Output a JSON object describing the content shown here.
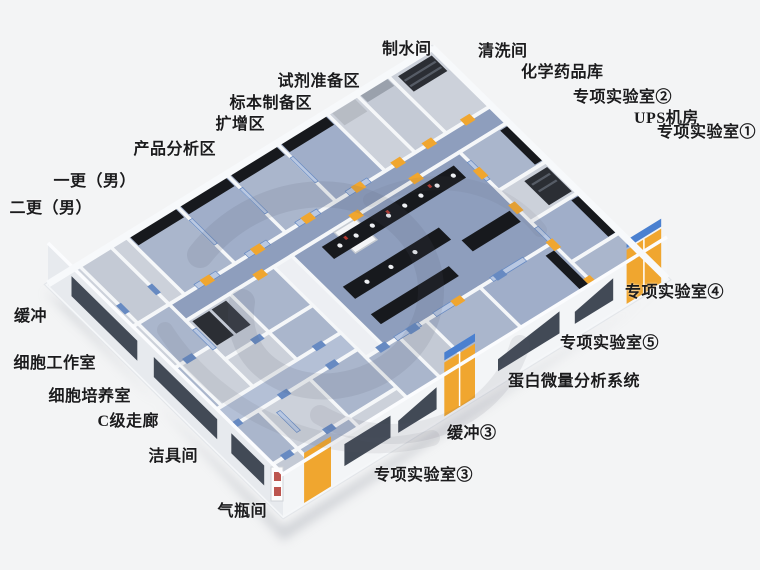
{
  "colors": {
    "background": "#f3f4f5",
    "wall": "#f5f7f9",
    "floor_blue": "#8e9ebd",
    "floor_blue_light": "#aab6cc",
    "floor_gray": "#ccd1da",
    "bench": "#17191d",
    "door_yellow": "#f0a62f",
    "door_blue": "#678ac2",
    "window_dark": "#424a56",
    "sign_blue": "#4a80d0",
    "label_text": "#1b1b1d"
  },
  "labels": [
    {
      "text": "制水间"
    },
    {
      "text": "清洗间"
    },
    {
      "text": "化学药品库"
    },
    {
      "text": "专项实验室②"
    },
    {
      "text": "UPS机房"
    },
    {
      "text": "专项实验室①"
    },
    {
      "text": "试剂准备区"
    },
    {
      "text": "标本制备区"
    },
    {
      "text": "扩增区"
    },
    {
      "text": "产品分析区"
    },
    {
      "text": "一更（男）"
    },
    {
      "text": "二更（男）"
    },
    {
      "text": "缓冲"
    },
    {
      "text": "细胞工作室"
    },
    {
      "text": "细胞培养室"
    },
    {
      "text": "C级走廊"
    },
    {
      "text": "洁具间"
    },
    {
      "text": "气瓶间"
    },
    {
      "text": "专项实验室④"
    },
    {
      "text": "专项实验室⑤"
    },
    {
      "text": "蛋白微量分析系统"
    },
    {
      "text": "缓冲③"
    },
    {
      "text": "专项实验室③"
    }
  ]
}
